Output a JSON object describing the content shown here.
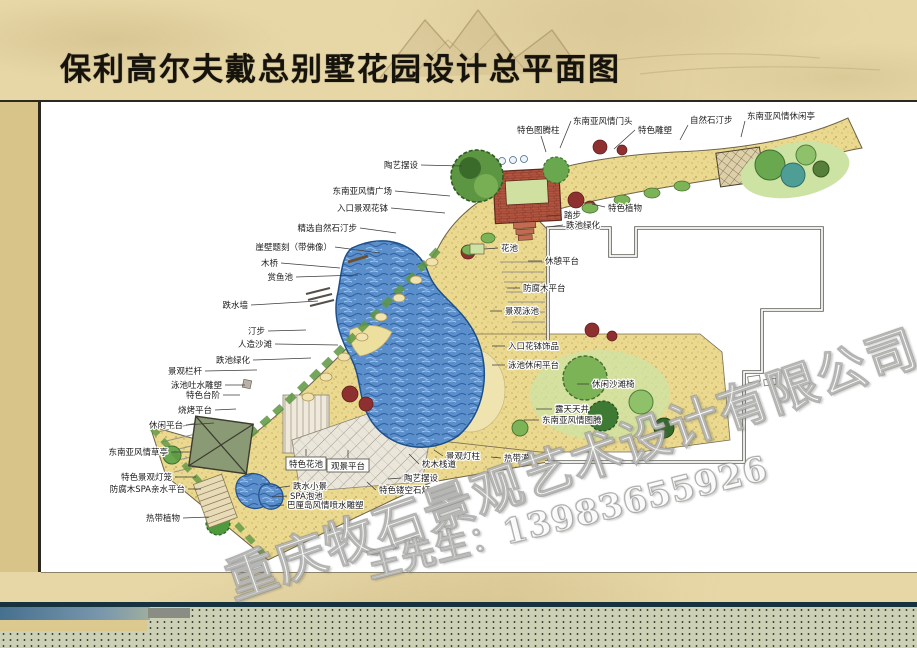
{
  "slide": {
    "title": "保利高尔夫戴总别墅花园设计总平面图"
  },
  "watermark": {
    "company": "重庆牧石景观艺术设计有限公司",
    "contact": "王先生：13983655926"
  },
  "colors": {
    "parchment": "#e7d7a7",
    "left_strip": "#d8c489",
    "frame_line": "#2a281f",
    "teal_bar": "#15323e",
    "dotted_bar": "#ccd0b4",
    "pool_water": "#5b8fcb",
    "brick_red": "#b2543f",
    "label_ink": "#1c1c1c"
  },
  "plan": {
    "labels": [
      {
        "t": "陶艺摆设",
        "a": "end",
        "x": 418,
        "y": 168,
        "l": [
          421,
          165,
          462,
          166
        ]
      },
      {
        "t": "东南亚风情广场",
        "a": "end",
        "x": 392,
        "y": 194,
        "l": [
          395,
          191,
          450,
          196
        ]
      },
      {
        "t": "入口景观花钵",
        "a": "end",
        "x": 388,
        "y": 211,
        "l": [
          391,
          208,
          445,
          213
        ]
      },
      {
        "t": "精选自然石汀步",
        "a": "end",
        "x": 357,
        "y": 231,
        "l": [
          360,
          228,
          396,
          233
        ]
      },
      {
        "t": "崖壁题刻（带佛像）",
        "a": "end",
        "x": 332,
        "y": 250,
        "l": [
          335,
          247,
          380,
          253
        ]
      },
      {
        "t": "木桥",
        "a": "end",
        "x": 278,
        "y": 266,
        "l": [
          281,
          263,
          340,
          268
        ]
      },
      {
        "t": "赏鱼池",
        "a": "end",
        "x": 293,
        "y": 280,
        "l": [
          296,
          277,
          358,
          275
        ]
      },
      {
        "t": "跌水墙",
        "a": "end",
        "x": 248,
        "y": 308,
        "l": [
          251,
          305,
          318,
          301
        ]
      },
      {
        "t": "汀步",
        "a": "end",
        "x": 265,
        "y": 334,
        "l": [
          268,
          331,
          306,
          330
        ]
      },
      {
        "t": "人造沙滩",
        "a": "end",
        "x": 272,
        "y": 347,
        "l": [
          275,
          344,
          338,
          345
        ]
      },
      {
        "t": "跌池绿化",
        "a": "end",
        "x": 250,
        "y": 363,
        "l": [
          253,
          360,
          311,
          358
        ]
      },
      {
        "t": "景观栏杆",
        "a": "end",
        "x": 202,
        "y": 374,
        "l": [
          205,
          371,
          257,
          370
        ]
      },
      {
        "t": "泳池吐水雕塑",
        "a": "end",
        "x": 222,
        "y": 388,
        "l": [
          225,
          385,
          245,
          385
        ]
      },
      {
        "t": "特色台阶",
        "a": "end",
        "x": 220,
        "y": 398,
        "l": [
          223,
          395,
          240,
          395
        ]
      },
      {
        "t": "烧烤平台",
        "a": "end",
        "x": 212,
        "y": 413,
        "l": [
          215,
          410,
          236,
          409
        ]
      },
      {
        "t": "休闲平台",
        "a": "end",
        "x": 183,
        "y": 428,
        "l": [
          186,
          425,
          214,
          423
        ]
      },
      {
        "t": "东南亚风情草亭",
        "a": "end",
        "x": 168,
        "y": 455,
        "l": [
          171,
          452,
          191,
          452
        ]
      },
      {
        "t": "特色景观灯笼",
        "a": "end",
        "x": 172,
        "y": 480,
        "l": [
          175,
          477,
          196,
          477
        ]
      },
      {
        "t": "防腐木SPA亲水平台",
        "a": "end",
        "x": 185,
        "y": 492,
        "l": [
          188,
          489,
          201,
          489
        ]
      },
      {
        "t": "热带植物",
        "a": "end",
        "x": 180,
        "y": 521,
        "l": [
          183,
          518,
          209,
          517
        ]
      },
      {
        "t": "特色图腾柱",
        "a": "start",
        "x": 517,
        "y": 133,
        "l": [
          541,
          136,
          546,
          152
        ]
      },
      {
        "t": "东南亚风情门头",
        "a": "start",
        "x": 573,
        "y": 124,
        "l": [
          571,
          121,
          560,
          148
        ]
      },
      {
        "t": "特色雕塑",
        "a": "start",
        "x": 638,
        "y": 133,
        "l": [
          635,
          130,
          614,
          149
        ]
      },
      {
        "t": "自然石汀步",
        "a": "start",
        "x": 690,
        "y": 123,
        "l": [
          688,
          125,
          680,
          140
        ]
      },
      {
        "t": "东南亚风情休闲亭",
        "a": "start",
        "x": 747,
        "y": 119,
        "l": [
          745,
          121,
          741,
          137
        ]
      },
      {
        "t": "特色植物",
        "a": "start",
        "x": 608,
        "y": 211,
        "l": [
          605,
          207,
          592,
          204
        ]
      },
      {
        "t": "踏步",
        "a": "start",
        "x": 564,
        "y": 218,
        "l": [
          561,
          215,
          546,
          216
        ]
      },
      {
        "t": "跌池绿化",
        "a": "start",
        "x": 566,
        "y": 228,
        "l": [
          563,
          225,
          548,
          227
        ]
      },
      {
        "t": "花池",
        "a": "start",
        "x": 501,
        "y": 251,
        "l": [
          498,
          248,
          484,
          249
        ]
      },
      {
        "t": "休憩平台",
        "a": "start",
        "x": 545,
        "y": 264,
        "l": [
          542,
          261,
          528,
          261
        ]
      },
      {
        "t": "防腐木平台",
        "a": "start",
        "x": 523,
        "y": 291,
        "l": [
          520,
          288,
          507,
          288
        ]
      },
      {
        "t": "景观泳池",
        "a": "start",
        "x": 505,
        "y": 314,
        "l": [
          502,
          311,
          490,
          311
        ]
      },
      {
        "t": "入口花钵饰品",
        "a": "start",
        "x": 508,
        "y": 349,
        "l": [
          505,
          346,
          492,
          346
        ]
      },
      {
        "t": "泳池休闲平台",
        "a": "start",
        "x": 508,
        "y": 368,
        "l": [
          505,
          365,
          492,
          365
        ]
      },
      {
        "t": "休闲沙滩椅",
        "a": "start",
        "x": 592,
        "y": 387,
        "l": [
          589,
          384,
          577,
          384
        ]
      },
      {
        "t": "露天天井",
        "a": "start",
        "x": 555,
        "y": 412,
        "l": [
          552,
          409,
          536,
          409
        ]
      },
      {
        "t": "东南亚风情图腾",
        "a": "start",
        "x": 542,
        "y": 423,
        "l": [
          539,
          420,
          524,
          420
        ]
      },
      {
        "t": "特色花池",
        "a": "middle",
        "x": 306,
        "y": 467,
        "box": [
          286,
          457,
          40,
          13
        ],
        "l": [
          306,
          456,
          306,
          449
        ]
      },
      {
        "t": "观景平台",
        "a": "middle",
        "x": 348,
        "y": 469,
        "box": [
          327,
          459,
          42,
          13
        ],
        "l": [
          348,
          458,
          348,
          450
        ]
      },
      {
        "t": "跌水小景",
        "a": "start",
        "x": 293,
        "y": 489,
        "l": [
          290,
          486,
          276,
          488
        ]
      },
      {
        "t": "SPA泡池",
        "a": "start",
        "x": 290,
        "y": 499,
        "l": [
          287,
          496,
          272,
          497
        ]
      },
      {
        "t": "巴厘岛风情喷水雕塑",
        "a": "start",
        "x": 287,
        "y": 508,
        "l": [
          284,
          505,
          269,
          506
        ]
      },
      {
        "t": "陶艺摆设",
        "a": "start",
        "x": 404,
        "y": 481,
        "l": [
          401,
          478,
          388,
          479
        ]
      },
      {
        "t": "特色镂空石灯",
        "a": "start",
        "x": 379,
        "y": 493,
        "l": [
          376,
          490,
          367,
          482
        ]
      },
      {
        "t": "景观灯柱",
        "a": "start",
        "x": 446,
        "y": 459,
        "l": [
          443,
          456,
          434,
          450
        ]
      },
      {
        "t": "枕木栈道",
        "a": "start",
        "x": 422,
        "y": 467,
        "l": [
          419,
          464,
          409,
          454
        ]
      },
      {
        "t": "热带灌木",
        "a": "start",
        "x": 504,
        "y": 461,
        "l": [
          501,
          458,
          491,
          457
        ]
      }
    ]
  }
}
